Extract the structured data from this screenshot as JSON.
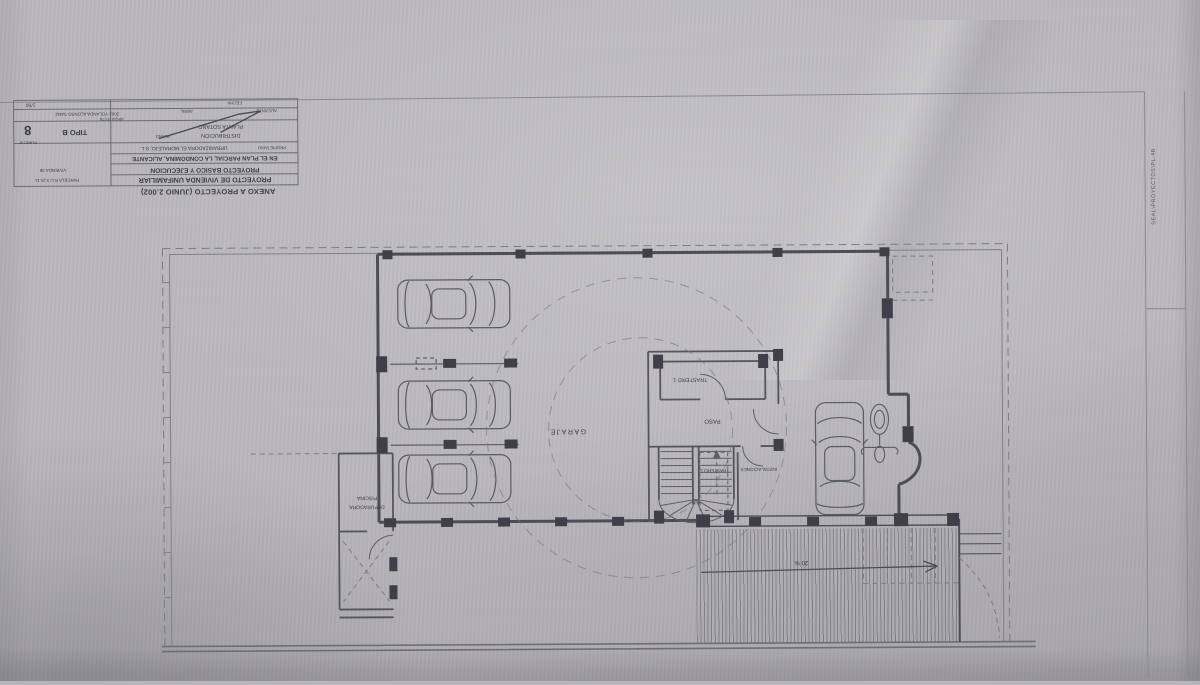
{
  "colors": {
    "paper": "#b9b7bc",
    "wall_line": "#4d4d57",
    "thin_line": "#5e5e68",
    "boundary_dash": "#7d7c86",
    "text": "#3d3d46"
  },
  "title_block": {
    "annex": "ANEXO A PROYECTO (JUNIO 2.002)",
    "project": "PROYECTO DE VIVIENDA UNIFAMILIAR",
    "project_line2": "PROYECTO BASICO Y EJECUCION",
    "project_line3": "EN EL PLAN PARCIAL LA CONDOMINA, ALICANTE",
    "owner_label": "PROPIETARIO",
    "owner": "URBANIZADORA EL MORALEJO, S.L.",
    "plan_label": "PLANO",
    "plan_name": "PLANTA SOTANO",
    "plan_name2": "DISTRIBUCION",
    "type": "TIPO B",
    "sheet_label": "PLANO N°",
    "sheet_number": "8",
    "parcel": "PARCELA R.U 3.25.11",
    "dwelling": "VIVIENDA 38",
    "architect_label": "ARQUITECTA",
    "architect": "2002  YOLANDA  ALONSO  SANZ",
    "month": "ABRIL",
    "city": "ALICANTE",
    "date_label": "FECHA",
    "scale": "1/50"
  },
  "plan_labels": {
    "garage": "GARAJE",
    "hall": "PASO",
    "storage1": "TRASTERO 1",
    "storage2": "TRASTERO 2",
    "utilities": "INSTALACIONES",
    "pool_line1": "PISCINA",
    "pool_line2": "DEPURADORA",
    "ramp_slope": "20 %"
  },
  "margin_note": "SEAL\\PROYECTOS\\PL.4B"
}
